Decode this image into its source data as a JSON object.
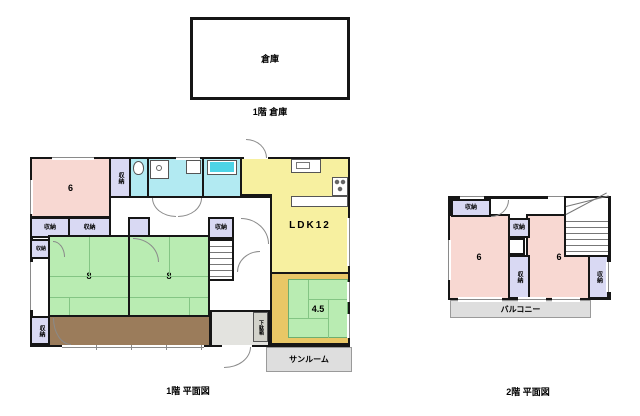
{
  "warehouse": {
    "label": "倉庫"
  },
  "captions": {
    "warehouse": "1階  倉庫",
    "floor1": "1階  平面図",
    "floor2": "2階  平面図"
  },
  "floor1": {
    "west_room": "6",
    "tatami_left": "8",
    "tatami_right": "8",
    "ldk": "LDK12",
    "tatami_small": "4.5",
    "storage": "収納",
    "shoe_cabinet": "下駄箱",
    "sunroom": "サンルーム"
  },
  "floor2": {
    "room_left": "6",
    "room_right": "6",
    "storage": "収納",
    "balcony": "バルコニー"
  },
  "colors": {
    "wall": "#161616",
    "pink_room": "#f8d8d2",
    "green_tatami": "#b9ecb2",
    "yellow_ldk": "#f7f0a0",
    "cyan_bath": "#b2eaf2",
    "bathtub": "#4ed4e6",
    "lavender_storage": "#d9d9f3",
    "brown_veranda": "#9b7c5b",
    "tan_floor": "#e9c766",
    "gray_terrace": "#dedede"
  }
}
